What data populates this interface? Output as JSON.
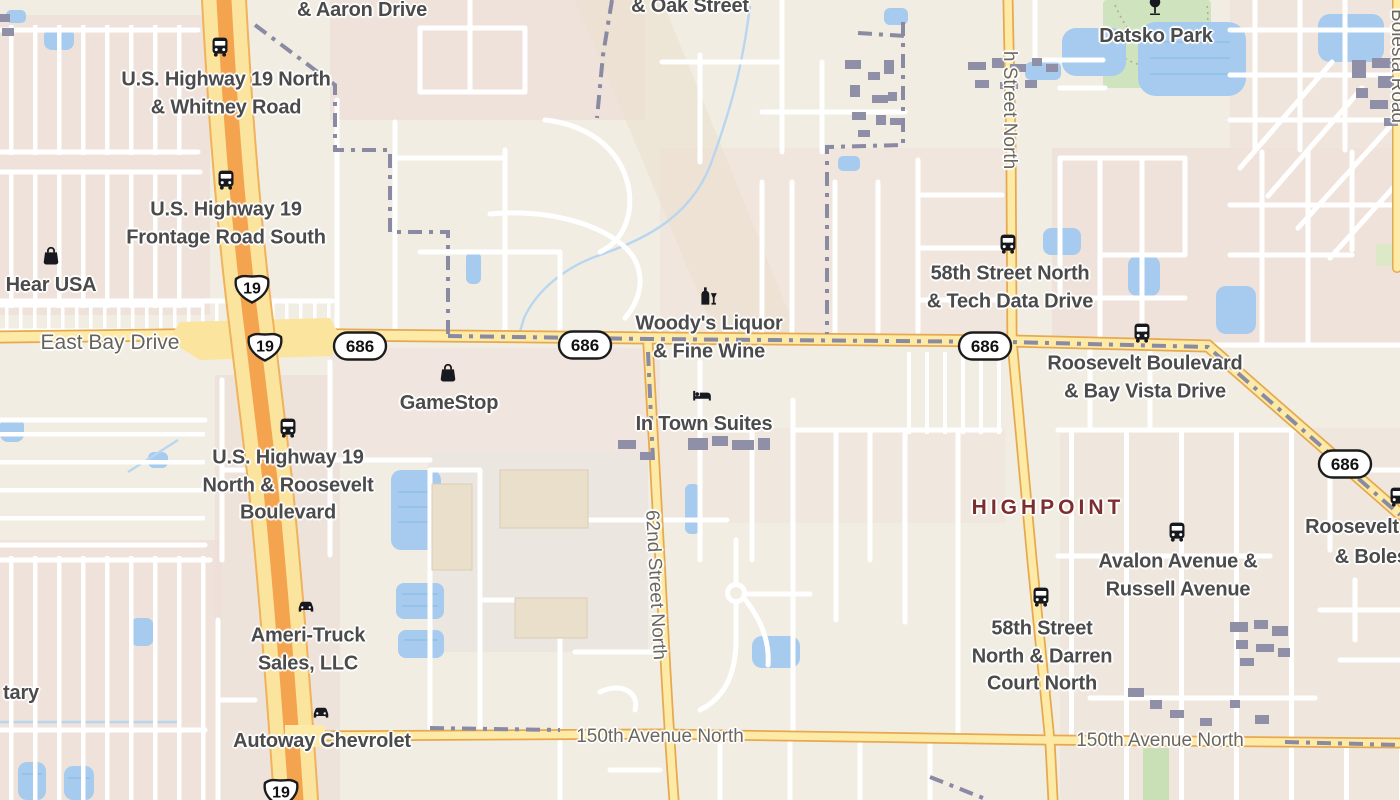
{
  "map": {
    "area_name": "Highpoint / Largo FL vicinity",
    "colors": {
      "background": "#f1ede3",
      "residential": "#efe2da",
      "water": "#a6cbee",
      "park_green": "#cfe4be",
      "road_yellow": "#fdeaa7",
      "road_casing": "#e6a94f",
      "highway_orange": "#f4a44f",
      "highway_body": "#fbe49e",
      "boundary": "#8a8aa3",
      "street_white": "#ffffff",
      "building": "#8f8fa8",
      "poi_label": "#4b4b4b",
      "road_label": "#6b675e",
      "place_label": "#7c2e2e"
    },
    "labels": [
      {
        "name": "label-aaron-drive",
        "lines": [
          "& Aaron Drive"
        ],
        "x": 362,
        "y": 11,
        "cls": "poi"
      },
      {
        "name": "label-us19-whitney",
        "lines": [
          "U.S. Highway 19 North",
          "& Whitney Road"
        ],
        "x": 226,
        "y": 94,
        "cls": "poi"
      },
      {
        "name": "label-oak-street",
        "lines": [
          "& Oak Street"
        ],
        "x": 690,
        "y": 7,
        "cls": "poi"
      },
      {
        "name": "label-datsko-park",
        "lines": [
          "Datsko Park"
        ],
        "x": 1156,
        "y": 37,
        "cls": "poi"
      },
      {
        "name": "label-us19-frontage",
        "lines": [
          "U.S. Highway 19",
          "Frontage Road South"
        ],
        "x": 226,
        "y": 224,
        "cls": "poi"
      },
      {
        "name": "label-hear-usa",
        "lines": [
          "Hear USA"
        ],
        "x": 51,
        "y": 286,
        "cls": "poi"
      },
      {
        "name": "label-east-bay-drive",
        "lines": [
          "East Bay Drive"
        ],
        "x": 110,
        "y": 343,
        "cls": "road-lg"
      },
      {
        "name": "label-gamestop",
        "lines": [
          "GameStop"
        ],
        "x": 449,
        "y": 404,
        "cls": "poi"
      },
      {
        "name": "label-woodys-liquor",
        "lines": [
          "Woody's Liquor",
          "& Fine Wine"
        ],
        "x": 709,
        "y": 338,
        "cls": "poi"
      },
      {
        "name": "label-in-town-suites",
        "lines": [
          "In Town Suites"
        ],
        "x": 704,
        "y": 425,
        "cls": "poi"
      },
      {
        "name": "label-58th-tech-data",
        "lines": [
          "58th Street North",
          "& Tech Data Drive"
        ],
        "x": 1010,
        "y": 288,
        "cls": "poi"
      },
      {
        "name": "label-roosevelt-bay-vista",
        "lines": [
          "Roosevelt Boulevard",
          "& Bay Vista Drive"
        ],
        "x": 1145,
        "y": 378,
        "cls": "poi"
      },
      {
        "name": "label-us19-roosevelt",
        "lines": [
          "U.S. Highway 19",
          "North & Roosevelt",
          "Boulevard"
        ],
        "x": 288,
        "y": 486,
        "cls": "poi"
      },
      {
        "name": "label-62nd-street-north",
        "lines": [
          "62nd Street North"
        ],
        "x": 655,
        "y": 585,
        "cls": "road",
        "rot": 87
      },
      {
        "name": "label-highpoint",
        "lines": [
          "HIGHPOINT"
        ],
        "x": 1048,
        "y": 508,
        "cls": "place"
      },
      {
        "name": "label-roosevelt-partial",
        "lines": [
          "Roosevelt"
        ],
        "x": 1352,
        "y": 528,
        "cls": "poi"
      },
      {
        "name": "label-bolesta-partial",
        "lines": [
          "& Bolesta"
        ],
        "x": 1380,
        "y": 558,
        "cls": "poi"
      },
      {
        "name": "label-avalon-russell",
        "lines": [
          "Avalon Avenue &",
          "Russell Avenue"
        ],
        "x": 1178,
        "y": 576,
        "cls": "poi"
      },
      {
        "name": "label-ameri-truck",
        "lines": [
          "Ameri-Truck",
          "Sales, LLC"
        ],
        "x": 308,
        "y": 650,
        "cls": "poi"
      },
      {
        "name": "label-58th-darren",
        "lines": [
          "58th Street",
          "North & Darren",
          "Court North"
        ],
        "x": 1042,
        "y": 657,
        "cls": "poi"
      },
      {
        "name": "label-autoway",
        "lines": [
          "Autoway Chevrolet"
        ],
        "x": 322,
        "y": 742,
        "cls": "poi"
      },
      {
        "name": "label-150th-ave-west",
        "lines": [
          "150th Avenue North"
        ],
        "x": 660,
        "y": 737,
        "cls": "road"
      },
      {
        "name": "label-150th-ave-east",
        "lines": [
          "150th Avenue North"
        ],
        "x": 1160,
        "y": 741,
        "cls": "road"
      },
      {
        "name": "label-tary-partial",
        "lines": [
          "tary"
        ],
        "x": 21,
        "y": 694,
        "cls": "poi"
      },
      {
        "name": "label-street-north-vertical",
        "lines": [
          "h Street North"
        ],
        "x": 1009,
        "y": 110,
        "cls": "road",
        "rot": 90
      },
      {
        "name": "label-bolesta-road",
        "lines": [
          "Bolesta Road"
        ],
        "x": 1397,
        "y": 66,
        "cls": "road",
        "rot": 90
      }
    ],
    "icons": [
      {
        "name": "bus-stop-icon-whitney",
        "sym": "bus",
        "x": 220,
        "y": 47
      },
      {
        "name": "bus-stop-icon-frontage",
        "sym": "bus",
        "x": 226,
        "y": 180
      },
      {
        "name": "bus-stop-icon-roosevelt",
        "sym": "bus",
        "x": 288,
        "y": 428
      },
      {
        "name": "bus-stop-icon-tech-data",
        "sym": "bus",
        "x": 1008,
        "y": 244
      },
      {
        "name": "bus-stop-icon-bay-vista",
        "sym": "bus",
        "x": 1142,
        "y": 333
      },
      {
        "name": "bus-stop-icon-avalon",
        "sym": "bus",
        "x": 1177,
        "y": 532
      },
      {
        "name": "bus-stop-icon-darren",
        "sym": "bus",
        "x": 1041,
        "y": 597
      },
      {
        "name": "bus-stop-icon-edge",
        "sym": "bus",
        "x": 1398,
        "y": 497
      },
      {
        "name": "shop-icon-hear-usa",
        "sym": "bag",
        "x": 51,
        "y": 255
      },
      {
        "name": "shop-icon-gamestop",
        "sym": "bag",
        "x": 448,
        "y": 372
      },
      {
        "name": "liquor-store-icon",
        "sym": "liquor",
        "x": 708,
        "y": 296
      },
      {
        "name": "lodging-icon",
        "sym": "bed",
        "x": 702,
        "y": 395
      },
      {
        "name": "car-dealer-icon-ameri",
        "sym": "car",
        "x": 306,
        "y": 605
      },
      {
        "name": "car-dealer-icon-autoway",
        "sym": "car",
        "x": 321,
        "y": 711
      },
      {
        "name": "park-tree-icon",
        "sym": "tree",
        "x": 1155,
        "y": 6
      }
    ],
    "shields": [
      {
        "name": "route-shield-us19-a",
        "type": "us",
        "num": "19",
        "x": 252,
        "y": 288
      },
      {
        "name": "route-shield-us19-b",
        "type": "us",
        "num": "19",
        "x": 265,
        "y": 346
      },
      {
        "name": "route-shield-us19-c",
        "type": "us",
        "num": "19",
        "x": 281,
        "y": 792
      },
      {
        "name": "route-shield-686-a",
        "type": "oval",
        "num": "686",
        "x": 360,
        "y": 346
      },
      {
        "name": "route-shield-686-b",
        "type": "oval",
        "num": "686",
        "x": 585,
        "y": 345
      },
      {
        "name": "route-shield-686-c",
        "type": "oval",
        "num": "686",
        "x": 985,
        "y": 346
      },
      {
        "name": "route-shield-686-d",
        "type": "oval",
        "num": "686",
        "x": 1345,
        "y": 464
      }
    ]
  }
}
